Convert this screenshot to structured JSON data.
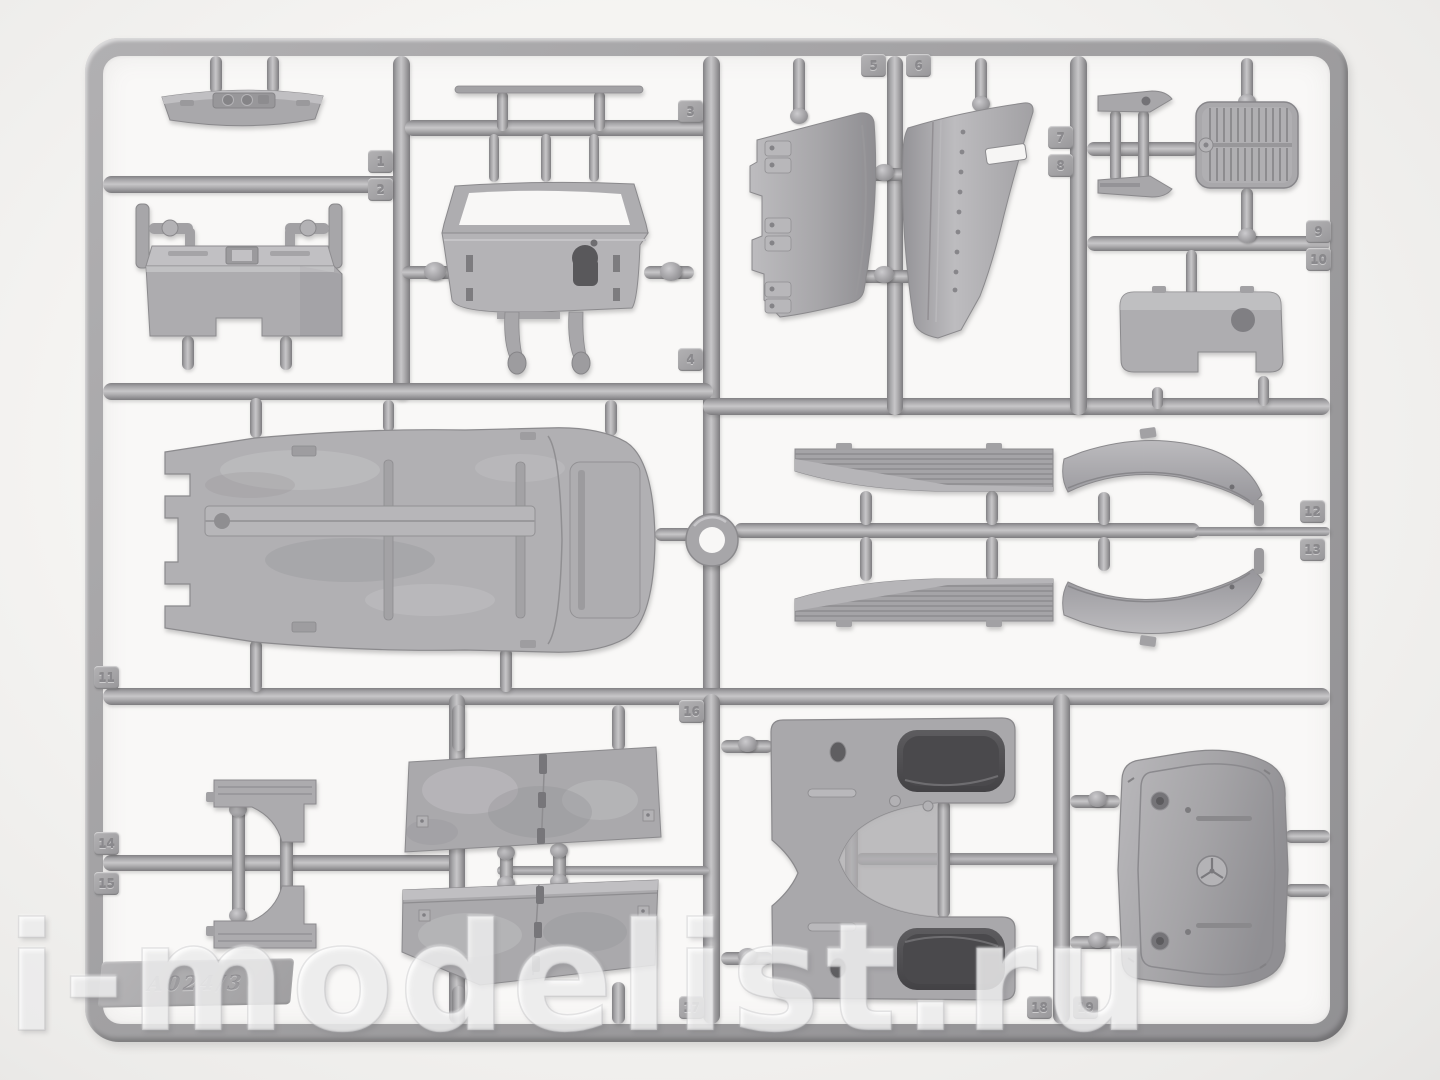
{
  "scene": {
    "subject": "Gray polystyrene model-kit sprue (runner frame) with molded car parts photographed on a light background",
    "plastic_color": "#a8a7aa",
    "background_color": "#f1f0ee",
    "dark_recess_color": "#4a494c"
  },
  "watermark": {
    "text": "i-modelist.ru"
  },
  "sprue": {
    "mold_stamp": "A024/3",
    "part_tags": [
      "1",
      "2",
      "3",
      "4",
      "5",
      "6",
      "7",
      "8",
      "9",
      "10",
      "11",
      "12",
      "13",
      "14",
      "15",
      "16",
      "17",
      "18",
      "19"
    ],
    "parts": [
      "instrument-panel",
      "bulkhead-firewall",
      "tie-rod",
      "windscreen-frame-with-cowl",
      "bonnet-side-panel-left",
      "bonnet-side-panel-right",
      "engine-mount-brackets",
      "ribbed-floor-plate",
      "rear-valance-panel",
      "chassis-floor-pan",
      "spare-wheel-ring",
      "running-board-left",
      "running-board-right",
      "rear-fender-left",
      "rear-fender-right",
      "fender-apron-upper",
      "fender-apron-lower",
      "bonnet-top-left",
      "bonnet-top-right",
      "front-fender-pair",
      "radiator-cowl-with-star-emblem"
    ]
  }
}
